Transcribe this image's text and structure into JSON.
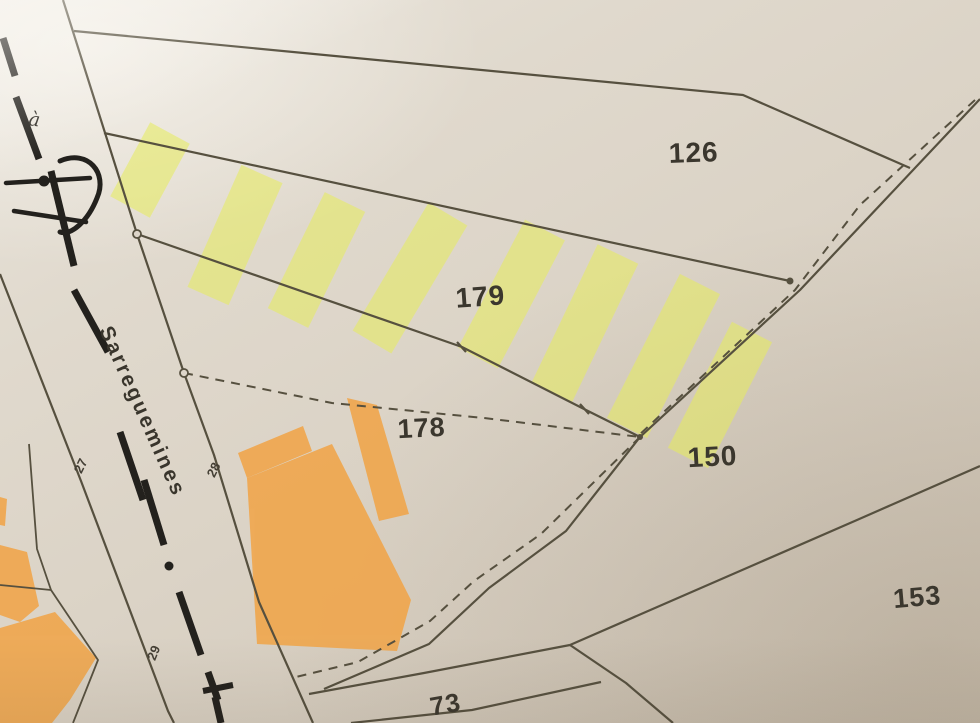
{
  "map": {
    "road": {
      "to_prefix": "à",
      "name": "Sarreguemines",
      "edge_numbers": [
        "27",
        "28",
        "29"
      ]
    },
    "parcels": [
      {
        "id": "126"
      },
      {
        "id": "179"
      },
      {
        "id": "178"
      },
      {
        "id": "150"
      },
      {
        "id": "153"
      },
      {
        "id": "73"
      }
    ],
    "colors": {
      "paper": "#ddd5c9",
      "boundary_line": "#56503f",
      "road_axis": "#23211d",
      "label_text": "#3b372e",
      "highlight_yellow": "#e7ed5c",
      "building_orange": "#f0a64c"
    }
  }
}
